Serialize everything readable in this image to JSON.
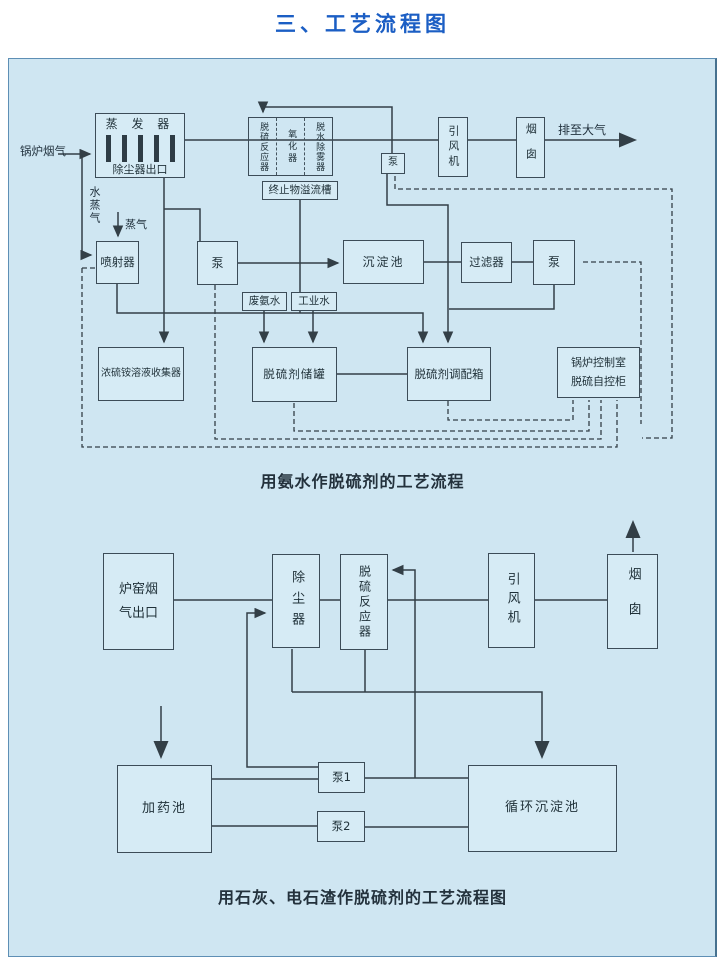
{
  "page": {
    "title": "三、工艺流程图"
  },
  "colors": {
    "panel_bg": "#cfe6f2",
    "box_bg": "#d6ebf5",
    "title_blue": "#1b5ec4",
    "line": "#333f47"
  },
  "diagram1": {
    "caption": "用氨水作脱硫剂的工艺流程",
    "labels": {
      "boiler_flue_gas": "锅炉烟气",
      "to_atmosphere": "排至大气",
      "water_vapor": "水蒸气",
      "steam": "蒸气"
    },
    "nodes": {
      "evaporator_top": "蒸 发 器",
      "evaporator_bottom": "除尘器出口",
      "reactor_col1": "脱硫反应器",
      "reactor_col2": "氧化器",
      "reactor_col3": "脱水除雾器",
      "overflow_trough": "终止物溢流槽",
      "pump_recirc": "泵",
      "induced_fan": "引风机",
      "chimney": "烟囱",
      "ejector": "喷射器",
      "pump_mid": "泵",
      "settling_tank": "沉淀池",
      "filter": "过滤器",
      "pump_right": "泵",
      "waste_ammonia": "废氨水",
      "industrial_water": "工业水",
      "collector": "浓硫铵溶液收集器",
      "storage_tank": "脱硫剂储罐",
      "mixing_box": "脱硫剂调配箱",
      "control_room_line1": "锅炉控制室",
      "control_room_line2": "脱硫自控柜"
    }
  },
  "diagram2": {
    "caption": "用石灰、电石渣作脱硫剂的工艺流程图",
    "nodes": {
      "furnace_outlet": "炉窑烟气出口",
      "dust_collector": "除尘器",
      "reactor": "脱硫反应器",
      "induced_fan": "引风机",
      "chimney": "烟囱",
      "dosing_pool": "加药池",
      "pump1": "泵1",
      "pump2": "泵2",
      "circulation_tank": "循环沉淀池"
    }
  }
}
